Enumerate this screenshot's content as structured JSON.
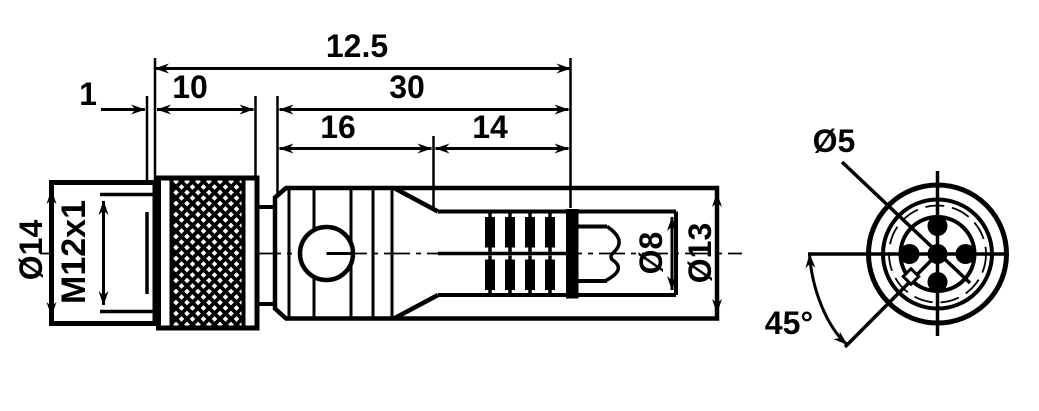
{
  "colors": {
    "line": "#000000",
    "background": "#ffffff"
  },
  "side_view": {
    "dim_overall": "12.5",
    "dim_relief": "1",
    "dim_knurl": "10",
    "dim_body": "30",
    "dim_front_section": "16",
    "dim_rear_section": "14",
    "dim_outer_diameter": "Ø14",
    "dim_thread": "M12x1",
    "dim_cable_diameter": "Ø8",
    "dim_gland_diameter": "Ø13"
  },
  "front_view": {
    "dim_pin_circle": "Ø5",
    "dim_pin_angle": "45°"
  }
}
